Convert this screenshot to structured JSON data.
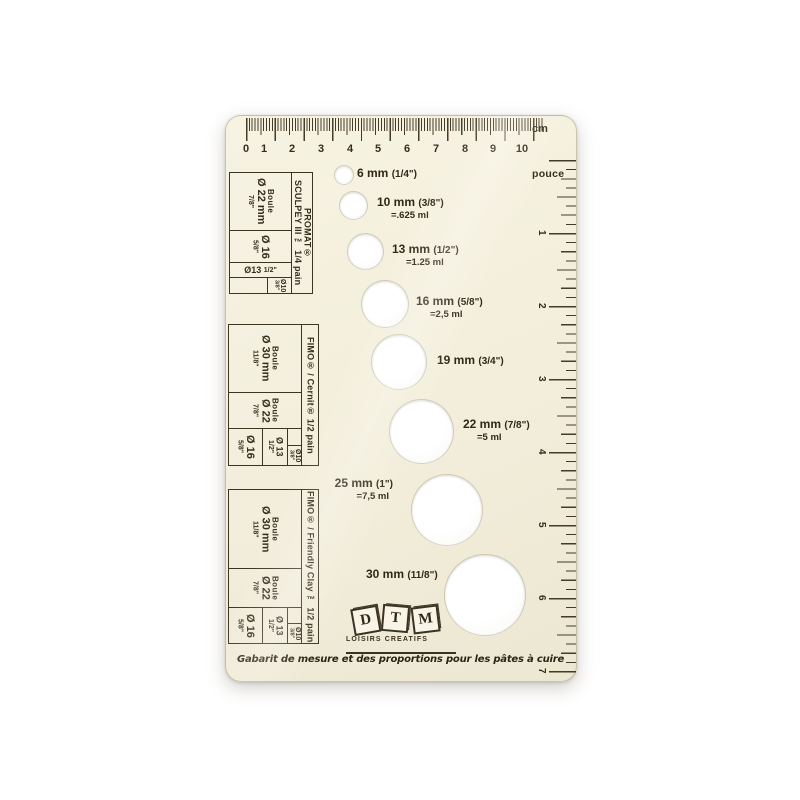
{
  "ruler_cm": {
    "unit": "cm",
    "numbers": [
      "0",
      "1",
      "2",
      "3",
      "4",
      "5",
      "6",
      "7",
      "8",
      "9",
      "10"
    ]
  },
  "ruler_inch": {
    "unit": "pouce",
    "numbers": [
      "1",
      "2",
      "3",
      "4",
      "5",
      "6",
      "7"
    ]
  },
  "holes": [
    {
      "size": "6 mm",
      "fraction": "(1/4\")",
      "volume": ""
    },
    {
      "size": "10 mm",
      "fraction": "(3/8\")",
      "volume": "=.625 ml"
    },
    {
      "size": "13 mm",
      "fraction": "(1/2\")",
      "volume": "=1.25 ml"
    },
    {
      "size": "16 mm",
      "fraction": "(5/8\")",
      "volume": "=2,5 ml"
    },
    {
      "size": "19 mm",
      "fraction": "(3/4\")",
      "volume": ""
    },
    {
      "size": "22 mm",
      "fraction": "(7/8\")",
      "volume": "=5 ml"
    },
    {
      "size": "25 mm",
      "fraction": "(1\")",
      "volume": "=7,5 ml"
    },
    {
      "size": "30 mm",
      "fraction": "(11/8\")",
      "volume": ""
    }
  ],
  "sections": [
    {
      "brand": [
        "PROMAT®",
        "SCULPEY III ™ 1/4 pain"
      ],
      "cells": [
        {
          "name": "Boule",
          "dia": "Ø 22 mm",
          "frac": "7/8\""
        },
        {
          "name": "",
          "dia": "Ø 16",
          "frac": "5/8\""
        },
        {
          "name": "",
          "dia": "Ø13",
          "frac": "1/2\""
        },
        {
          "name": "",
          "dia": "Ø10",
          "frac": "3/8\""
        }
      ]
    },
    {
      "brand": [
        "FIMO® / Cernit® 1/2 pain"
      ],
      "cells": [
        {
          "name": "Boule",
          "dia": "Ø 30 mm",
          "frac": "11/8\""
        },
        {
          "name": "Boule",
          "dia": "Ø 22",
          "frac": "7/8\""
        },
        {
          "name": "",
          "dia": "Ø 16",
          "frac": "5/8\""
        },
        {
          "name": "",
          "dia": "Ø 13",
          "frac": "1/2\""
        },
        {
          "name": "",
          "dia": "Ø10",
          "frac": "3/8\""
        }
      ]
    },
    {
      "brand": [
        "FIMO® / Friendly Clay ™ 1/2 pain"
      ],
      "cells": [
        {
          "name": "Boule",
          "dia": "Ø 30 mm",
          "frac": "11/8\""
        },
        {
          "name": "Boule",
          "dia": "Ø 22",
          "frac": "7/8\""
        },
        {
          "name": "",
          "dia": "Ø 16",
          "frac": "5/8\""
        },
        {
          "name": "",
          "dia": "Ø 13",
          "frac": "1/2\""
        },
        {
          "name": "",
          "dia": "Ø10",
          "frac": "3/8\""
        }
      ]
    }
  ],
  "logo": {
    "blocks": [
      "D",
      "T",
      "M"
    ],
    "subtitle": "LOISIRS CREATIFS"
  },
  "caption": "Gabarit de mesure et des proportions pour les pâtes à cuire",
  "colors": {
    "card": "#f3eedb",
    "ink": "#3a3223"
  }
}
